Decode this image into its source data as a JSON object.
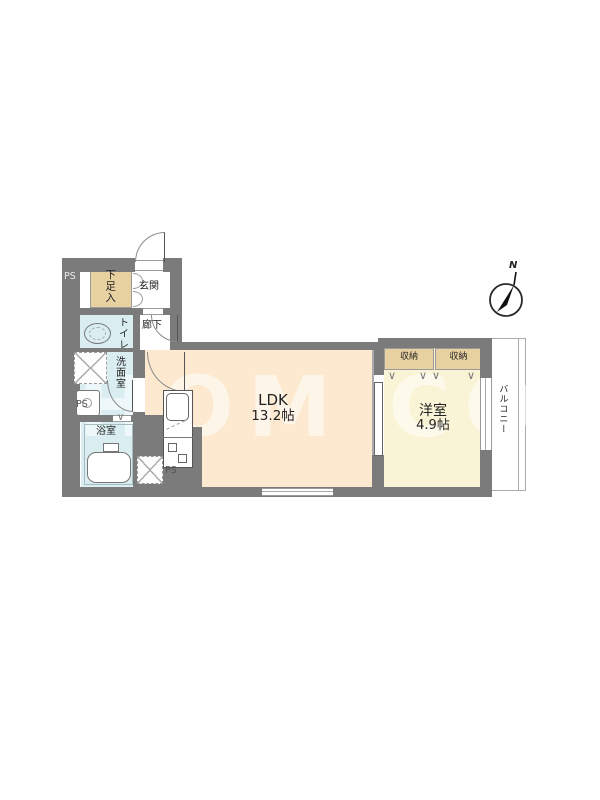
{
  "floorplan": {
    "watermark": "HOM CORK",
    "compass_label": "N",
    "rooms": {
      "ldk_name": "LDK",
      "ldk_size": "13.2帖",
      "western_name": "洋室",
      "western_size": "4.9帖",
      "entrance": "玄関",
      "hallway": "廊下",
      "toilet": "トイレ",
      "washroom": "洗面室",
      "bathroom": "浴室",
      "shoe_cabinet": "下足入",
      "closet1": "収納",
      "closet2": "収納",
      "balcony": "バルコニー",
      "ps_top": "PS",
      "ps_mid": "PS",
      "ps_bottom": "PS"
    },
    "icons": {
      "hanger_mark": "∨",
      "bath_door_mark": "∨"
    },
    "colors": {
      "wall": "#7b7b7b",
      "ldk_floor": "#fce9cf",
      "western_floor": "#faf4d6",
      "wet_area_floor": "#daeef1",
      "storage": "#e7d1a1"
    }
  }
}
